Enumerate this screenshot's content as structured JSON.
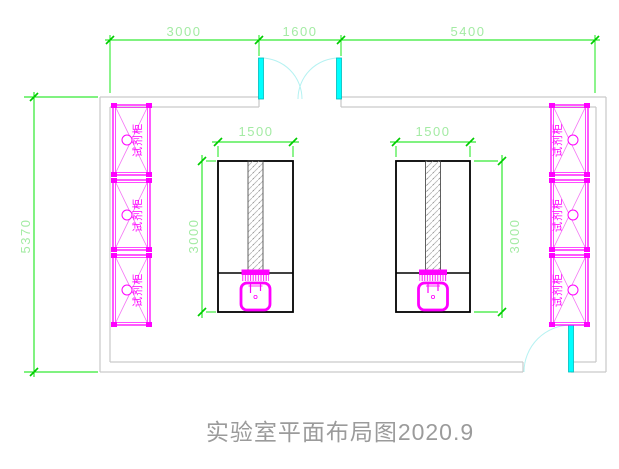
{
  "drawing": {
    "title": "实验室平面布局图2020.9"
  },
  "dimensions": {
    "top_left": "3000",
    "top_middle": "1600",
    "top_right": "5400",
    "left_wall": "5370",
    "left_island_width": "1500",
    "left_island_depth": "3000",
    "right_island_width": "1500",
    "right_island_depth": "3000"
  },
  "cabinets": {
    "left": [
      {
        "label": "试剂柜"
      },
      {
        "label": "试剂柜"
      },
      {
        "label": "试剂柜"
      }
    ],
    "right": [
      {
        "label": "试剂柜"
      },
      {
        "label": "试剂柜"
      },
      {
        "label": "试剂柜"
      }
    ]
  },
  "colors": {
    "dimension_line": "#00e600",
    "dimension_text": "#a4eba4",
    "furniture": "#ff00ff",
    "island_outline": "#000000",
    "wall": "#c9c9c9",
    "door_leaf": "#00ffff",
    "door_arc": "#b5f2f2",
    "title": "#9b9b9b"
  }
}
